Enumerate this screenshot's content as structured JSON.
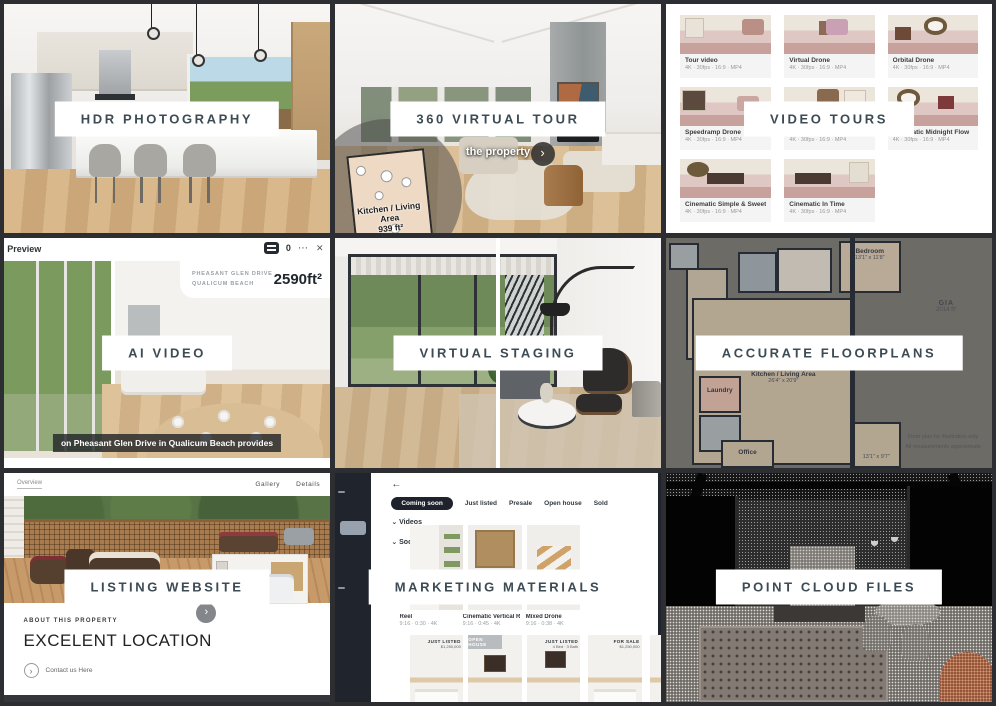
{
  "page": {
    "bg": "#2c2e31"
  },
  "banners": {
    "hdr": "HDR PHOTOGRAPHY",
    "tour": "360 VIRTUAL TOUR",
    "video_tours": "VIDEO TOURS",
    "ai_video": "AI VIDEO",
    "staging": "VIRTUAL STAGING",
    "floorplans": "ACCURATE FLOORPLANS",
    "website": "LISTING WEBSITE",
    "marketing": "MARKETING MATERIALS",
    "point_cloud": "POINT CLOUD FILES"
  },
  "tour": {
    "subtitle": "the property",
    "minimap_room": "Kitchen / Living Area",
    "minimap_area": "939 ft²",
    "nav_arrow": "›"
  },
  "video_tours": {
    "cards": [
      {
        "title": "Tour video",
        "meta": "4K · 30fps · 16:9 · MP4"
      },
      {
        "title": "Virtual Drone",
        "meta": "4K · 30fps · 16:9 · MP4"
      },
      {
        "title": "Orbital Drone",
        "meta": "4K · 30fps · 16:9 · MP4"
      },
      {
        "title": "Speedramp Drone",
        "meta": "4K · 30fps · 16:9 · MP4"
      },
      {
        "title": "Cinematic Analog Light",
        "meta": "4K · 30fps · 16:9 · MP4"
      },
      {
        "title": "Cinematic Midnight Flow",
        "meta": "4K · 30fps · 16:9 · MP4"
      },
      {
        "title": "Cinematic Simple & Sweet",
        "meta": "4K · 30fps · 16:9 · MP4"
      },
      {
        "title": "Cinematic In Time",
        "meta": "4K · 30fps · 16:9 · MP4"
      }
    ]
  },
  "ai_video": {
    "window_title": "Preview",
    "badge_count": "0",
    "menu_icon": "⋯",
    "close_icon": "✕",
    "address_line1": "PHEASANT GLEN DRIVE",
    "address_line2": "QUALICUM BEACH",
    "area": "2590ft²",
    "caption": "on Pheasant Glen Drive in Qualicum Beach provides"
  },
  "floorplans": {
    "bedroom": "Bedroom",
    "bedroom_dims": "13'1\" x 11'8\"",
    "living": "Kitchen / Living Area",
    "living_dims": "26'4\" x 20'9\"",
    "laundry": "Laundry",
    "office": "Office",
    "dim_note": "13'1\" x 9'7\"",
    "gia_label": "GIA",
    "gia_value": "2014 ft²",
    "footer1": "Floor plan for illustration only",
    "footer2": "All measurements approximate"
  },
  "website": {
    "logo": "Overview",
    "nav_gallery": "Gallery",
    "nav_details": "Details",
    "inset_arrow": "›",
    "about_label": "ABOUT THIS PROPERTY",
    "headline": "EXCELENT LOCATION",
    "cta_icon": "›",
    "cta_label": "Contact us Here"
  },
  "marketing": {
    "back_icon": "←",
    "filters": [
      "Coming soon",
      "Just listed",
      "Presale",
      "Open house",
      "Sold"
    ],
    "chevron": "⌄",
    "section_videos": "Videos",
    "section_social": "Social Media",
    "videos": [
      {
        "title": "Reel",
        "meta": "9:16 · 0:30 · 4K"
      },
      {
        "title": "Cinematic Vertical Reel",
        "meta": "9:16 · 0:45 · 4K"
      },
      {
        "title": "Mixed Drone",
        "meta": "9:16 · 0:38 · 4K"
      }
    ],
    "social": [
      {
        "line1": "JUST LISTED",
        "line2": "$1,250,000"
      },
      {
        "line1": "OPEN HOUSE",
        "line2": ""
      },
      {
        "line1": "JUST LISTED",
        "line2": "4 Bed · 3 Bath"
      },
      {
        "line1": "FOR SALE",
        "line2": "$1,250,000"
      }
    ]
  }
}
